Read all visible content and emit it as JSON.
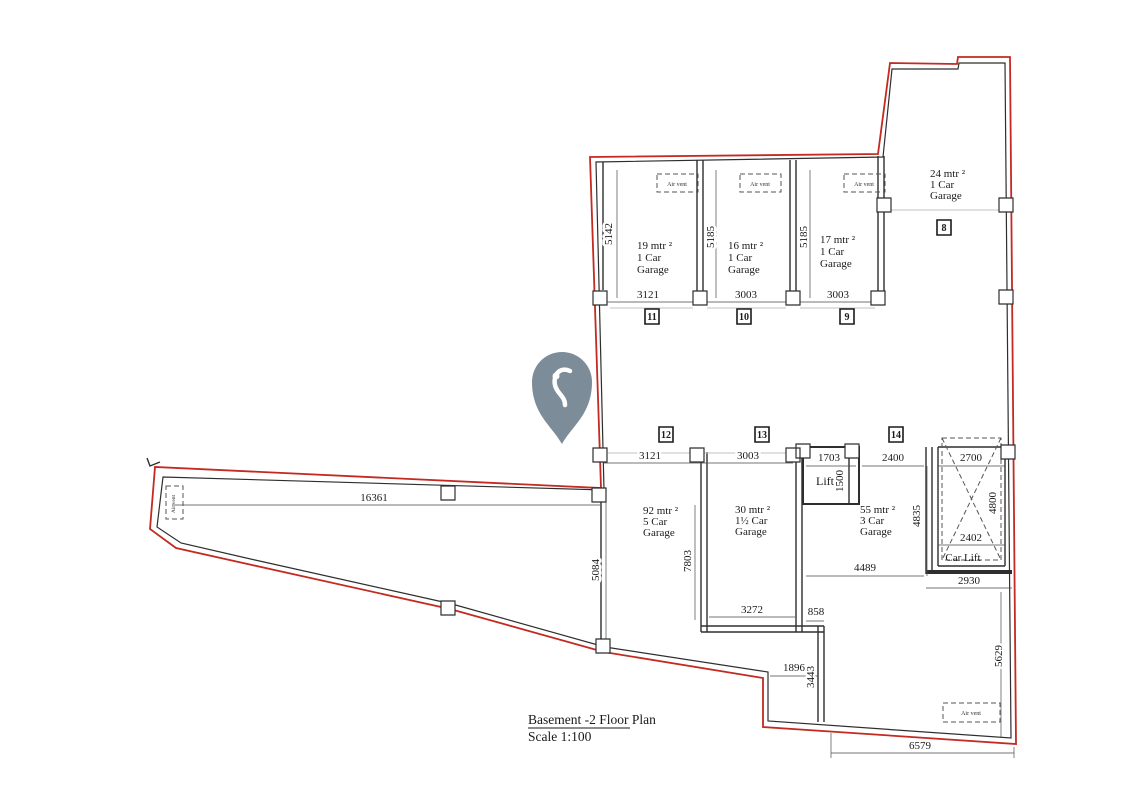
{
  "title_block": {
    "title": "Basement -2 Floor Plan",
    "scale": "Scale 1:100"
  },
  "labels": {
    "air_vent": "Air vent",
    "lift": "Lift",
    "car_lift": "Car Lift"
  },
  "rooms": {
    "g19": {
      "l1": "19 mtr ²",
      "l2": "1 Car",
      "l3": "Garage"
    },
    "g16": {
      "l1": "16 mtr ²",
      "l2": "1 Car",
      "l3": "Garage"
    },
    "g17": {
      "l1": "17 mtr ²",
      "l2": "1 Car",
      "l3": "Garage"
    },
    "g24": {
      "l1": "24 mtr ²",
      "l2": "1 Car",
      "l3": "Garage"
    },
    "g92": {
      "l1": "92 mtr ²",
      "l2": "5 Car",
      "l3": "Garage"
    },
    "g30": {
      "l1": "30 mtr ²",
      "l2": "1½ Car",
      "l3": "Garage"
    },
    "g55": {
      "l1": "55 mtr ²",
      "l2": "3 Car",
      "l3": "Garage"
    }
  },
  "markers": {
    "m8": "8",
    "m9": "9",
    "m10": "10",
    "m11": "11",
    "m12": "12",
    "m13": "13",
    "m14": "14"
  },
  "dims": {
    "g19_w": "3121",
    "g16_w": "3003",
    "g17_w": "3003",
    "g19_d": "5142",
    "g16_d": "5185",
    "g17_d": "5185",
    "mid_3121": "3121",
    "mid_3003": "3003",
    "lift_w": "1703",
    "lift_d": "1500",
    "mid_2400": "2400",
    "carlift_top": "2700",
    "carlift_d": "4800",
    "carlift_inner": "2402",
    "carlift_out": "2930",
    "g55_w": "4489",
    "g55_d": "4835",
    "g30_w": "3272",
    "g30_d": "7803",
    "g92_d": "5084",
    "wing": "16361",
    "step": "858",
    "notch_w": "1896",
    "notch_d": "3443",
    "right": "5629",
    "bottom": "6579"
  },
  "colors": {
    "boundary": "#c32a21",
    "wall": "#2e2e2e",
    "dim": "#4a4a4a",
    "pin": "#7d8c99"
  },
  "icons": {
    "pin": "location-pin"
  }
}
